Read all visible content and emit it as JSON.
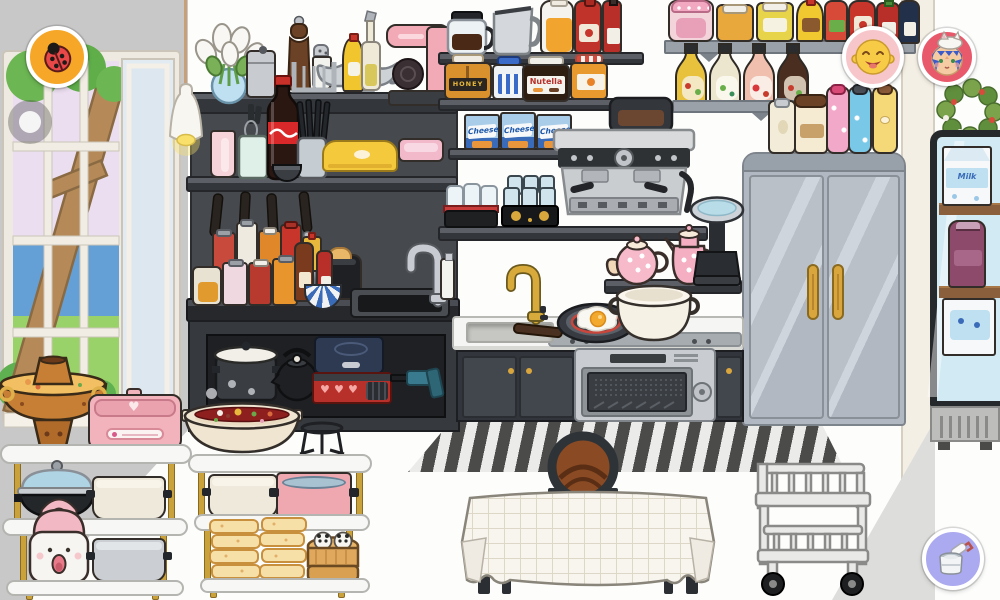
{
  "scene": {
    "style": "toca-life-kitchen",
    "room": "kitchen"
  },
  "labels": {
    "honey": "HONEY",
    "nutella": "Nutella",
    "cheese": "Cheese",
    "milk": "Milk"
  },
  "icons": {
    "heart": "♥"
  },
  "buttons": [
    {
      "name": "ladybug-button",
      "icon": "ladybug-icon",
      "bg": "#F6A728"
    },
    {
      "name": "nav-dot-button",
      "icon": "dot-icon",
      "bg": "rgba(80,80,80,0.38)"
    },
    {
      "name": "profile-yellow-button",
      "icon": "yellow-laughing-face-icon",
      "bg": "#F7C6CB"
    },
    {
      "name": "profile-blue-button",
      "icon": "blue-hair-cat-hat-face-icon",
      "bg": "#E8596B"
    },
    {
      "name": "paint-button",
      "icon": "paint-bucket-roller-icon",
      "bg": "#ABA9F0"
    }
  ],
  "palette": {
    "wall_left": "#C8C8C8",
    "wall_main": "#FDFDFC",
    "unit_dark": "#46494E",
    "slab_dark": "#33363B",
    "board_gray": "#9BA1A8",
    "fridge": "#B7BDC5",
    "fridge_handle": "#D9A63E",
    "counter": "#F5F5F3",
    "cabinet": "#42464D",
    "oven_steel": "#C9CDD1",
    "coke_red": "#D8282A",
    "rug_dark": "#4B4B49",
    "rug_light": "#EBEBE9",
    "brass": "#C67F35",
    "broth_yellow": "#F2C063",
    "broth_red": "#8E1F1F",
    "pink_appliance": "#F3B3BC",
    "glass_lid_blue": "#AFD4E4",
    "bamboo": "#E0A85C",
    "gold_leg": "#C9A23C",
    "vending_frame": "#26292C",
    "vending_glass": "#D2EAF4",
    "wreath_green": "#7AA34B",
    "accent_orange": "#F6A728",
    "paint_purple": "#ABA9F0",
    "profile_pink": "#F7C6CB",
    "profile_red": "#E8596B"
  },
  "inventory": {
    "window_wall": [
      "window",
      "tree-view",
      "pendant-lamp"
    ],
    "dark_shelf_unit": [
      "calla-lily-bouquet",
      "metal-canister",
      "pepper-grinder",
      "salt-shaker",
      "metal-rack",
      "gravy-boat",
      "mustard-bottle",
      "oil-bottle",
      "pink-coffee-maker",
      "pink-cup",
      "whisk-jar",
      "cola-bottle",
      "knife-block",
      "small-bowl",
      "butter-dish-yellow",
      "pink-tray",
      "hanging-knives",
      "spatula",
      "spice-jars",
      "oil-jug",
      "brown-sauce-bottle",
      "red-sauce-bottle",
      "toaster",
      "patterned-bowl",
      "left-sink",
      "chrome-faucet",
      "soap-pump",
      "stock-pot",
      "black-kettle",
      "induction-cooktop",
      "gas-stove",
      "kitchen-torch"
    ],
    "center_shelves": [
      "coffee-carafe",
      "metal-pitcher",
      "orange-juice-bottle",
      "ketchup-bottle",
      "hot-sauce-bottle",
      "honey-jar",
      "blue-jam-jar",
      "nutella-jar",
      "marmalade-jar",
      "cheese-box-1",
      "cheese-box-2",
      "cheese-box-3",
      "glass-set-red-tray",
      "glass-set-black-tray"
    ],
    "coffee_station": [
      "espresso-machine",
      "kitchen-scale",
      "round-teapot",
      "tall-teapot"
    ],
    "kitchen_counter": [
      "gold-faucet",
      "sink-basin",
      "frying-pan-with-egg",
      "soup-pot",
      "cooktop",
      "oven",
      "cabinet-doors"
    ],
    "refrigerator": [
      "double-door-fridge",
      "cream-thermos",
      "coffee-tumbler",
      "pink-bottle",
      "blue-bottle",
      "yellow-bottle"
    ],
    "condiment_shelves": [
      "pink-jam-jar",
      "honey-pot",
      "honey-pot-2",
      "mustard-squeeze",
      "vinegar-bottle",
      "ketchup-bottle-2",
      "chili-sauce-bottle",
      "soy-sauce-bottle",
      "dressing-bottle-italian",
      "dressing-bottle-ranch",
      "dressing-bottle-strawberry",
      "dressing-bottle-balsamic"
    ],
    "right_side": [
      "wreath",
      "beverage-cooler",
      "milk-carton",
      "grape-juice-bottle",
      "milk-carton-2"
    ],
    "dining": [
      "striped-rug",
      "dining-table",
      "bentwood-chair",
      "serving-cart"
    ],
    "left_shelves": [
      "brass-hotpot",
      "pink-multicooker",
      "wok-glass-lid",
      "cream-pot",
      "rice-cooker",
      "gray-pot",
      "divided-hotpot",
      "wire-stand",
      "cream-pot-2",
      "pink-pot",
      "bread-stack-1",
      "bread-stack-2",
      "bamboo-steamer-pandas"
    ]
  }
}
